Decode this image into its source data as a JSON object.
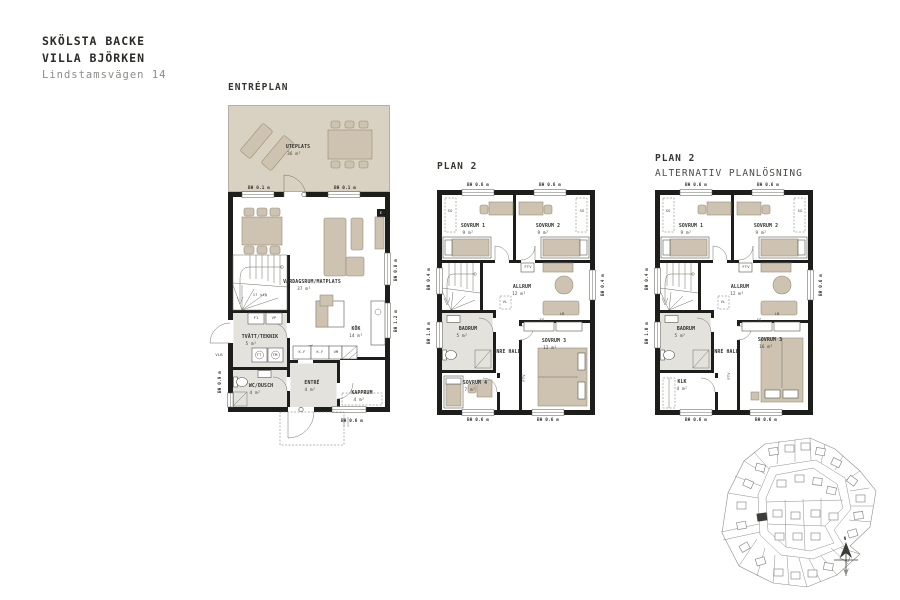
{
  "header": {
    "project": "SKÖLSTA BACKE",
    "house": "VILLA BJÖRKEN",
    "address": "Lindstamsvägen 14"
  },
  "colors": {
    "wall": "#1d1d1b",
    "furniture": "#cdc3b0",
    "terrace": "#d9d1c1",
    "wetroom": "#e4e2dd",
    "highlight_lot": "#3c3c38"
  },
  "plans": [
    {
      "id": "entreplan",
      "title": "ENTRÉPLAN",
      "subtitle": "",
      "labels": [
        {
          "t": "UTEPLATS",
          "x": 70,
          "y": 42,
          "s": 4.8,
          "b": 1
        },
        {
          "t": "36 m²",
          "x": 66,
          "y": 49,
          "s": 4.3
        },
        {
          "t": "BH 0.1 m",
          "x": 31,
          "y": 83,
          "s": 4.3,
          "b": 1
        },
        {
          "t": "BH 0.1 m",
          "x": 117,
          "y": 83,
          "s": 4.3,
          "b": 1
        },
        {
          "t": "VARDAGSRUM/MATPLATS",
          "x": 84,
          "y": 177,
          "s": 4.8,
          "b": 1
        },
        {
          "t": "37 m²",
          "x": 76,
          "y": 184,
          "s": 4.3
        },
        {
          "t": "17 stg",
          "x": 32,
          "y": 190,
          "s": 3.8
        },
        {
          "t": "F1",
          "x": 28,
          "y": 213,
          "s": 3.8
        },
        {
          "t": "VP",
          "x": 46,
          "y": 213,
          "s": 3.8
        },
        {
          "t": "TVÄTT/TEKNIK",
          "x": 32,
          "y": 232,
          "s": 4.8,
          "b": 1
        },
        {
          "t": "5 m²",
          "x": 23,
          "y": 239,
          "s": 4.3
        },
        {
          "t": "TT",
          "x": 31,
          "y": 250,
          "s": 3.8
        },
        {
          "t": "TM",
          "x": 47,
          "y": 250,
          "s": 3.8
        },
        {
          "t": "WC/DUSCH",
          "x": 33,
          "y": 281,
          "s": 4.8,
          "b": 1
        },
        {
          "t": "4 m²",
          "x": 27,
          "y": 288,
          "s": 4.3
        },
        {
          "t": "ENTRÉ",
          "x": 84,
          "y": 278,
          "s": 4.8,
          "b": 1
        },
        {
          "t": "4 m²",
          "x": 82,
          "y": 285,
          "s": 4.3
        },
        {
          "t": "KAPPRUM",
          "x": 134,
          "y": 288,
          "s": 4.8,
          "b": 1
        },
        {
          "t": "4 m²",
          "x": 131,
          "y": 295,
          "s": 4.3
        },
        {
          "t": "KÖK",
          "x": 128,
          "y": 224,
          "s": 4.8,
          "b": 1
        },
        {
          "t": "14 m²",
          "x": 128,
          "y": 231,
          "s": 4.3
        },
        {
          "t": "K.F",
          "x": 74,
          "y": 247,
          "s": 3.6
        },
        {
          "t": "K.F",
          "x": 92,
          "y": 247,
          "s": 3.6
        },
        {
          "t": "UM",
          "x": 108,
          "y": 247,
          "s": 3.6
        },
        {
          "t": "E",
          "x": 153,
          "y": 108,
          "s": 3.8,
          "c": "#ffffff"
        },
        {
          "t": "BH 0.6 m",
          "x": 124,
          "y": 316,
          "s": 4.3,
          "b": 1
        },
        {
          "t": "VLB",
          "x": -9,
          "y": 250,
          "s": 3.8
        },
        {
          "t": "BH 0.9 m",
          "x": -8,
          "y": 277,
          "s": 4.3,
          "b": 1,
          "r": -90
        },
        {
          "t": "BH 0.8 m",
          "x": 168,
          "y": 165,
          "s": 4.3,
          "b": 1,
          "r": -90
        },
        {
          "t": "BH 1.2 m",
          "x": 168,
          "y": 216,
          "s": 4.3,
          "b": 1,
          "r": -90
        }
      ]
    },
    {
      "id": "plan2",
      "title": "PLAN 2",
      "subtitle": "",
      "labels": [
        {
          "t": "BH 0.6 m",
          "x": 41,
          "y": -5,
          "s": 4.3,
          "b": 1
        },
        {
          "t": "BH 0.6 m",
          "x": 113,
          "y": -5,
          "s": 4.3,
          "b": 1
        },
        {
          "t": "SG",
          "x": 13,
          "y": 21,
          "s": 3.8
        },
        {
          "t": "SG",
          "x": 145,
          "y": 21,
          "s": 3.8
        },
        {
          "t": "SOVRUM 1",
          "x": 36,
          "y": 36,
          "s": 4.8,
          "b": 1
        },
        {
          "t": "9 m²",
          "x": 31,
          "y": 43,
          "s": 4.3
        },
        {
          "t": "SOVRUM 2",
          "x": 111,
          "y": 36,
          "s": 4.8,
          "b": 1
        },
        {
          "t": "9 m²",
          "x": 106,
          "y": 43,
          "s": 4.3
        },
        {
          "t": "FTV",
          "x": 91,
          "y": 77,
          "s": 3.8
        },
        {
          "t": "ALLRUM",
          "x": 85,
          "y": 97,
          "s": 4.8,
          "b": 1
        },
        {
          "t": "12 m²",
          "x": 82,
          "y": 104,
          "s": 4.3
        },
        {
          "t": "VL",
          "x": 68,
          "y": 112,
          "s": 3.8
        },
        {
          "t": "LB",
          "x": 125,
          "y": 124,
          "s": 3.8
        },
        {
          "t": "SG",
          "x": 105,
          "y": 130,
          "s": 3.8
        },
        {
          "t": "BADRUM",
          "x": 31,
          "y": 139,
          "s": 4.8,
          "b": 1
        },
        {
          "t": "5 m²",
          "x": 25,
          "y": 146,
          "s": 4.3
        },
        {
          "t": "INRE HALL",
          "x": 70,
          "y": 162,
          "s": 4.8,
          "b": 1
        },
        {
          "t": "SOVRUM 3",
          "x": 117,
          "y": 151,
          "s": 4.8,
          "b": 1
        },
        {
          "t": "12 m²",
          "x": 113,
          "y": 158,
          "s": 4.3
        },
        {
          "t": "SOVRUM 4",
          "x": 38,
          "y": 193,
          "s": 4.8,
          "b": 1
        },
        {
          "t": "7 m²",
          "x": 33,
          "y": 200,
          "s": 4.3
        },
        {
          "t": "FTV",
          "x": 87,
          "y": 188,
          "s": 3.8,
          "r": -90
        },
        {
          "t": "BH 0.6 m",
          "x": 41,
          "y": 230,
          "s": 4.3,
          "b": 1
        },
        {
          "t": "BH 0.6 m",
          "x": 111,
          "y": 230,
          "s": 4.3,
          "b": 1
        },
        {
          "t": "BH 0.4 m",
          "x": -8,
          "y": 89,
          "s": 4.3,
          "b": 1,
          "r": -90
        },
        {
          "t": "BH 1.0 m",
          "x": -8,
          "y": 143,
          "s": 4.3,
          "b": 1,
          "r": -90
        },
        {
          "t": "BH 0.4 m",
          "x": 166,
          "y": 95,
          "s": 4.3,
          "b": 1,
          "r": -90
        }
      ]
    },
    {
      "id": "plan2alt",
      "title": "PLAN 2",
      "subtitle": "ALTERNATIV PLANLÖSNING",
      "labels": [
        {
          "t": "BH 0.6 m",
          "x": 41,
          "y": -5,
          "s": 4.3,
          "b": 1
        },
        {
          "t": "BH 0.6 m",
          "x": 113,
          "y": -5,
          "s": 4.3,
          "b": 1
        },
        {
          "t": "SG",
          "x": 13,
          "y": 21,
          "s": 3.8
        },
        {
          "t": "SG",
          "x": 145,
          "y": 21,
          "s": 3.8
        },
        {
          "t": "SOVRUM 1",
          "x": 36,
          "y": 36,
          "s": 4.8,
          "b": 1
        },
        {
          "t": "9 m²",
          "x": 31,
          "y": 43,
          "s": 4.3
        },
        {
          "t": "SOVRUM 2",
          "x": 111,
          "y": 36,
          "s": 4.8,
          "b": 1
        },
        {
          "t": "9 m²",
          "x": 106,
          "y": 43,
          "s": 4.3
        },
        {
          "t": "FTV",
          "x": 91,
          "y": 77,
          "s": 3.8
        },
        {
          "t": "ALLRUM",
          "x": 85,
          "y": 97,
          "s": 4.8,
          "b": 1
        },
        {
          "t": "12 m²",
          "x": 82,
          "y": 104,
          "s": 4.3
        },
        {
          "t": "VL",
          "x": 68,
          "y": 112,
          "s": 3.8
        },
        {
          "t": "LB",
          "x": 122,
          "y": 124,
          "s": 3.8
        },
        {
          "t": "SG",
          "x": 104,
          "y": 130,
          "s": 3.8
        },
        {
          "t": "BADRUM",
          "x": 31,
          "y": 139,
          "s": 4.8,
          "b": 1
        },
        {
          "t": "5 m²",
          "x": 25,
          "y": 146,
          "s": 4.3
        },
        {
          "t": "INRE HALL",
          "x": 70,
          "y": 162,
          "s": 4.8,
          "b": 1
        },
        {
          "t": "SOVRUM 3",
          "x": 115,
          "y": 150,
          "s": 4.8,
          "b": 1
        },
        {
          "t": "16 m²",
          "x": 111,
          "y": 157,
          "s": 4.3
        },
        {
          "t": "KLK",
          "x": 27,
          "y": 192,
          "s": 4.8,
          "b": 1
        },
        {
          "t": "4 m²",
          "x": 27,
          "y": 199,
          "s": 4.3
        },
        {
          "t": "FTV",
          "x": 74,
          "y": 186,
          "s": 3.8,
          "r": -90
        },
        {
          "t": "BH 0.6 m",
          "x": 41,
          "y": 230,
          "s": 4.3,
          "b": 1
        },
        {
          "t": "BH 0.6 m",
          "x": 111,
          "y": 230,
          "s": 4.3,
          "b": 1
        },
        {
          "t": "BH 0.4 m",
          "x": -8,
          "y": 89,
          "s": 4.3,
          "b": 1,
          "r": -90
        },
        {
          "t": "BH 1.0 m",
          "x": -8,
          "y": 143,
          "s": 4.3,
          "b": 1,
          "r": -90
        },
        {
          "t": "BH 0.6 m",
          "x": 166,
          "y": 95,
          "s": 4.3,
          "b": 1,
          "r": -90
        }
      ]
    }
  ],
  "siteplan": {
    "labels": [
      {
        "t": "N",
        "x": 133,
        "y": 103,
        "s": 4,
        "b": 1
      }
    ]
  }
}
